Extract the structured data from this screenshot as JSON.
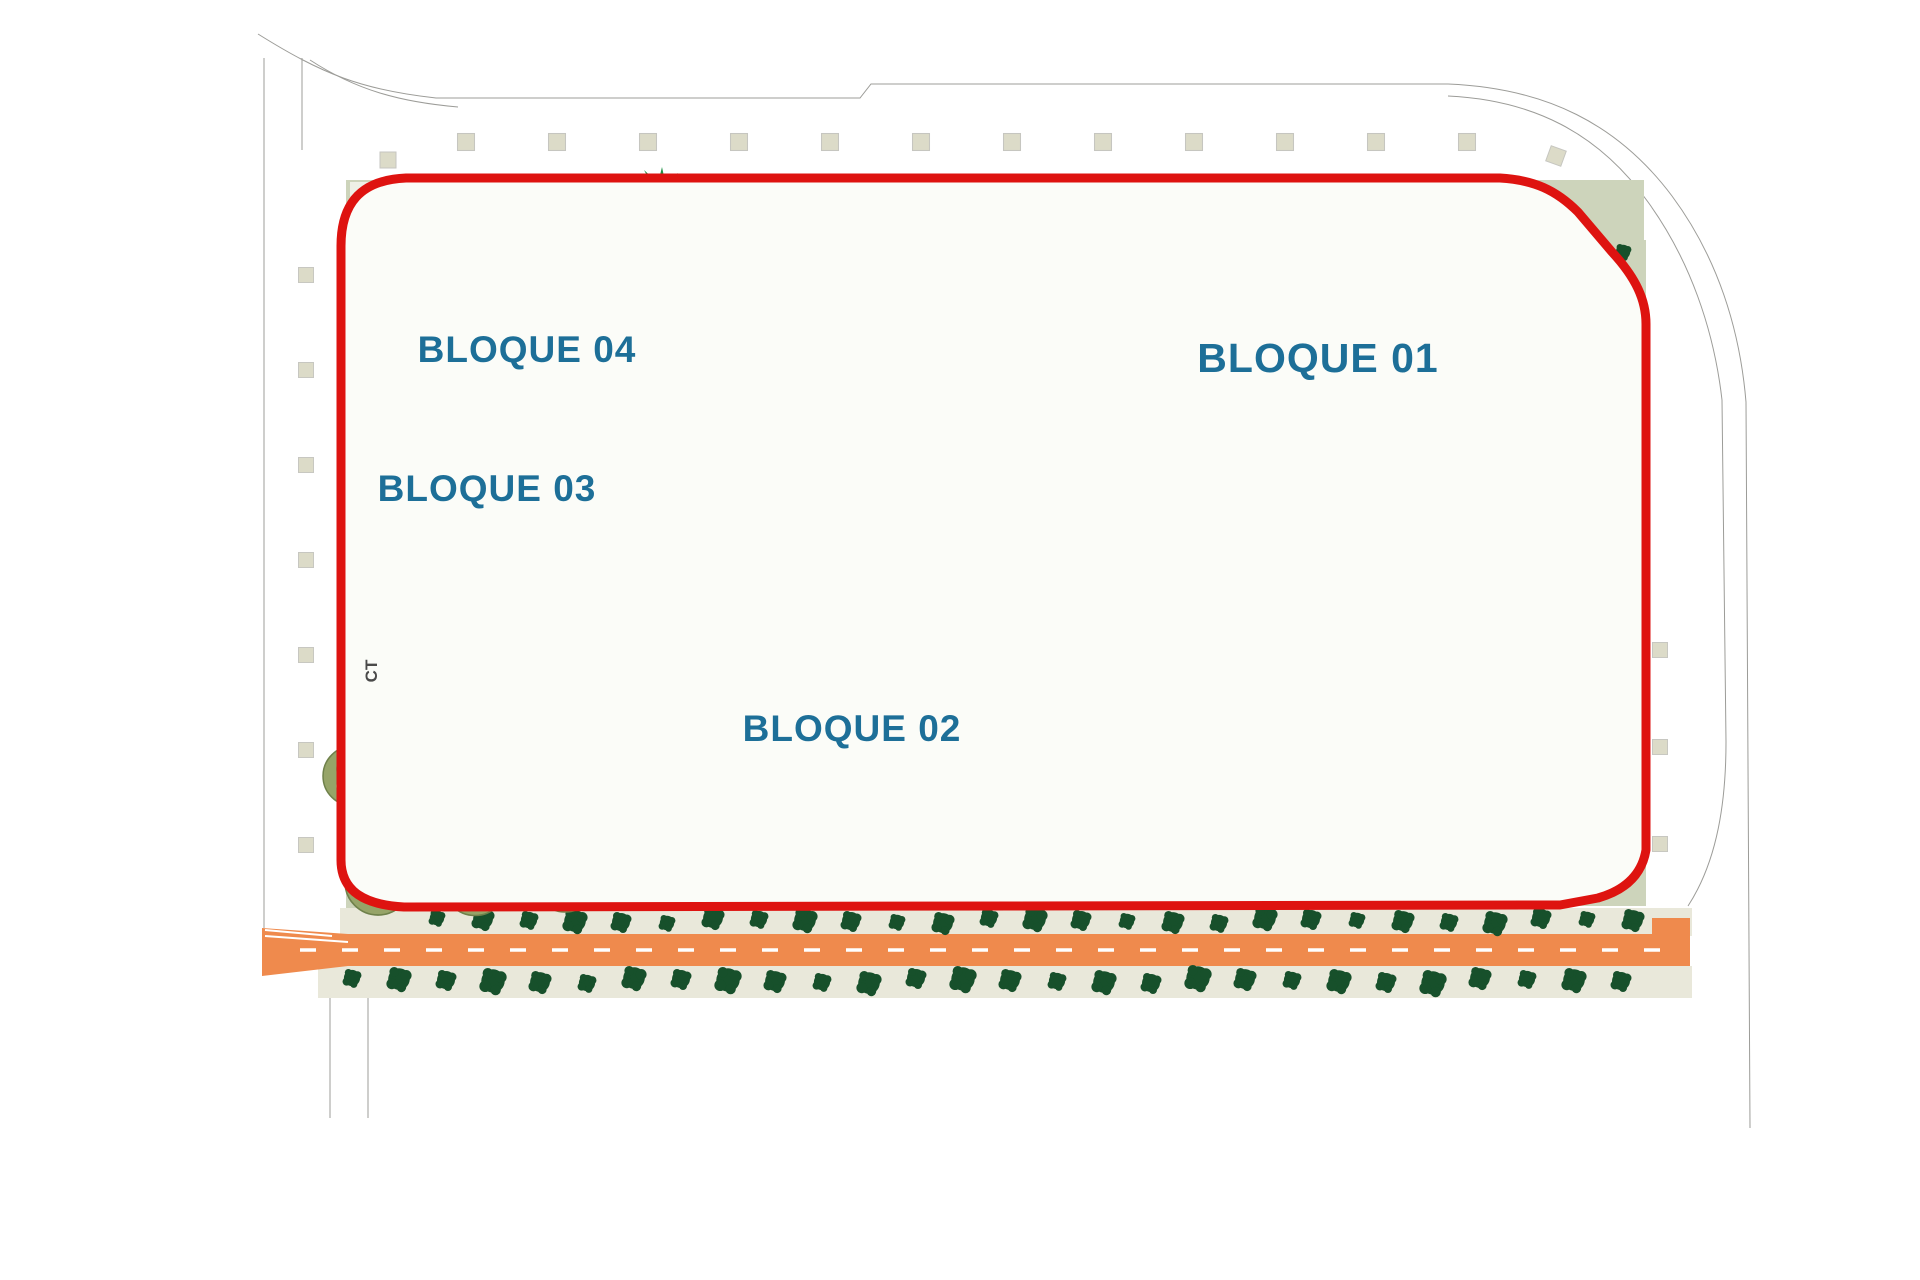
{
  "plan": {
    "labels": {
      "bloque01": {
        "text": "BLOQUE 01"
      },
      "bloque02": {
        "text": "BLOQUE 02"
      },
      "bloque03": {
        "text": "BLOQUE 03"
      },
      "bloque04": {
        "text": "BLOQUE 04"
      },
      "ct": {
        "text": "CT"
      }
    },
    "colors": {
      "boundary": "#de1310",
      "label": "#1d6f98",
      "ct_label": "#4a4a4a",
      "sage": "#cdd4bb",
      "sage_dark": "#c7cfb2",
      "pale": "#eef0e6",
      "garden": "#f3f4ec",
      "base": "#fbfcf8",
      "pool": "#bfe8f0",
      "pool_edge": "#93c7d2",
      "road": "#ef8a4d",
      "strip": "#e9e8da",
      "line": "#9c9c98",
      "line_light": "#c6c6c0",
      "bldg": "#8b8b87",
      "tree_dark": "#17502b",
      "tree_med": "#5c8a63",
      "palm_bright": "#1d9146",
      "palm_dark": "#14532d",
      "olive": "#96a468",
      "olive_dark": "#6f814b",
      "olive_light": "#c2cf8e",
      "square": "#dcdbc8"
    },
    "decor": {
      "tree_rows": [
        {
          "id": "row-above-road",
          "axis": "h",
          "x0": 437,
          "x1": 1637,
          "y": 921,
          "step": 46,
          "r": 10,
          "color": "td"
        },
        {
          "id": "row-below-road",
          "axis": "h",
          "x0": 352,
          "x1": 1658,
          "y": 981,
          "step": 47,
          "r": 11,
          "color": "td"
        },
        {
          "id": "col-walkway-left",
          "axis": "v",
          "x": 686,
          "y0": 252,
          "y1": 416,
          "step": 27,
          "r": 8,
          "color": "td"
        },
        {
          "id": "col-walkway-mid",
          "axis": "v",
          "x": 979,
          "y0": 192,
          "y1": 402,
          "step": 30,
          "r": 10,
          "color": "td"
        },
        {
          "id": "col-b03-right",
          "axis": "v",
          "x": 637,
          "y0": 502,
          "y1": 616,
          "step": 28,
          "r": 8,
          "color": "td",
          "alt": true
        },
        {
          "id": "col-right-strip",
          "axis": "v",
          "x": 1627,
          "y0": 252,
          "y1": 862,
          "step": 44,
          "r": 10,
          "color": "td",
          "alt": true
        }
      ],
      "square_rows": [
        {
          "id": "squares-top",
          "axis": "h",
          "x0": 466,
          "x1": 1467,
          "y": 142,
          "step": 91,
          "size": 17
        },
        {
          "id": "squares-left",
          "axis": "v",
          "x": 306,
          "y0": 275,
          "y1": 845,
          "step": 95,
          "size": 15
        },
        {
          "id": "squares-right",
          "axis": "v",
          "x": 1660,
          "y0": 650,
          "y1": 845,
          "step": 97,
          "size": 15
        }
      ],
      "lounger_rows": [
        {
          "id": "loungers-b01",
          "x0": 1108,
          "y0": 502,
          "x1": 1345,
          "y1": 540,
          "n": 12,
          "rot": 65
        },
        {
          "id": "loungers-amphi-top",
          "x0": 1445,
          "y0": 564,
          "x1": 1566,
          "y1": 564,
          "n": 9,
          "rot": 0
        },
        {
          "id": "loungers-deck-bottom",
          "x0": 1416,
          "y0": 872,
          "x1": 1516,
          "y1": 872,
          "n": 7,
          "rot": 0
        },
        {
          "id": "loungers-amphi-left",
          "x0": 1143,
          "y0": 636,
          "x1": 1194,
          "y1": 662,
          "n": 4,
          "rot": -48
        },
        {
          "id": "loungers-pool-left",
          "x0": 1272,
          "y0": 756,
          "x1": 1322,
          "y1": 790,
          "n": 4,
          "rot": 42
        },
        {
          "id": "loungers-band",
          "arc": {
            "cx": 1400,
            "cy": 662,
            "r": 150,
            "a0": 132,
            "a1": 222,
            "n": 6
          }
        }
      ],
      "amphitheater": {
        "cx": 1400,
        "cy": 662,
        "r_inner": 92,
        "r_outer": 180,
        "angle_start": 118,
        "angle_end": 242,
        "radials": 14,
        "arc_radii": [
          100,
          113,
          126,
          139,
          152,
          165
        ]
      },
      "road_dash": {
        "dash": 16,
        "gap": 26
      }
    }
  }
}
